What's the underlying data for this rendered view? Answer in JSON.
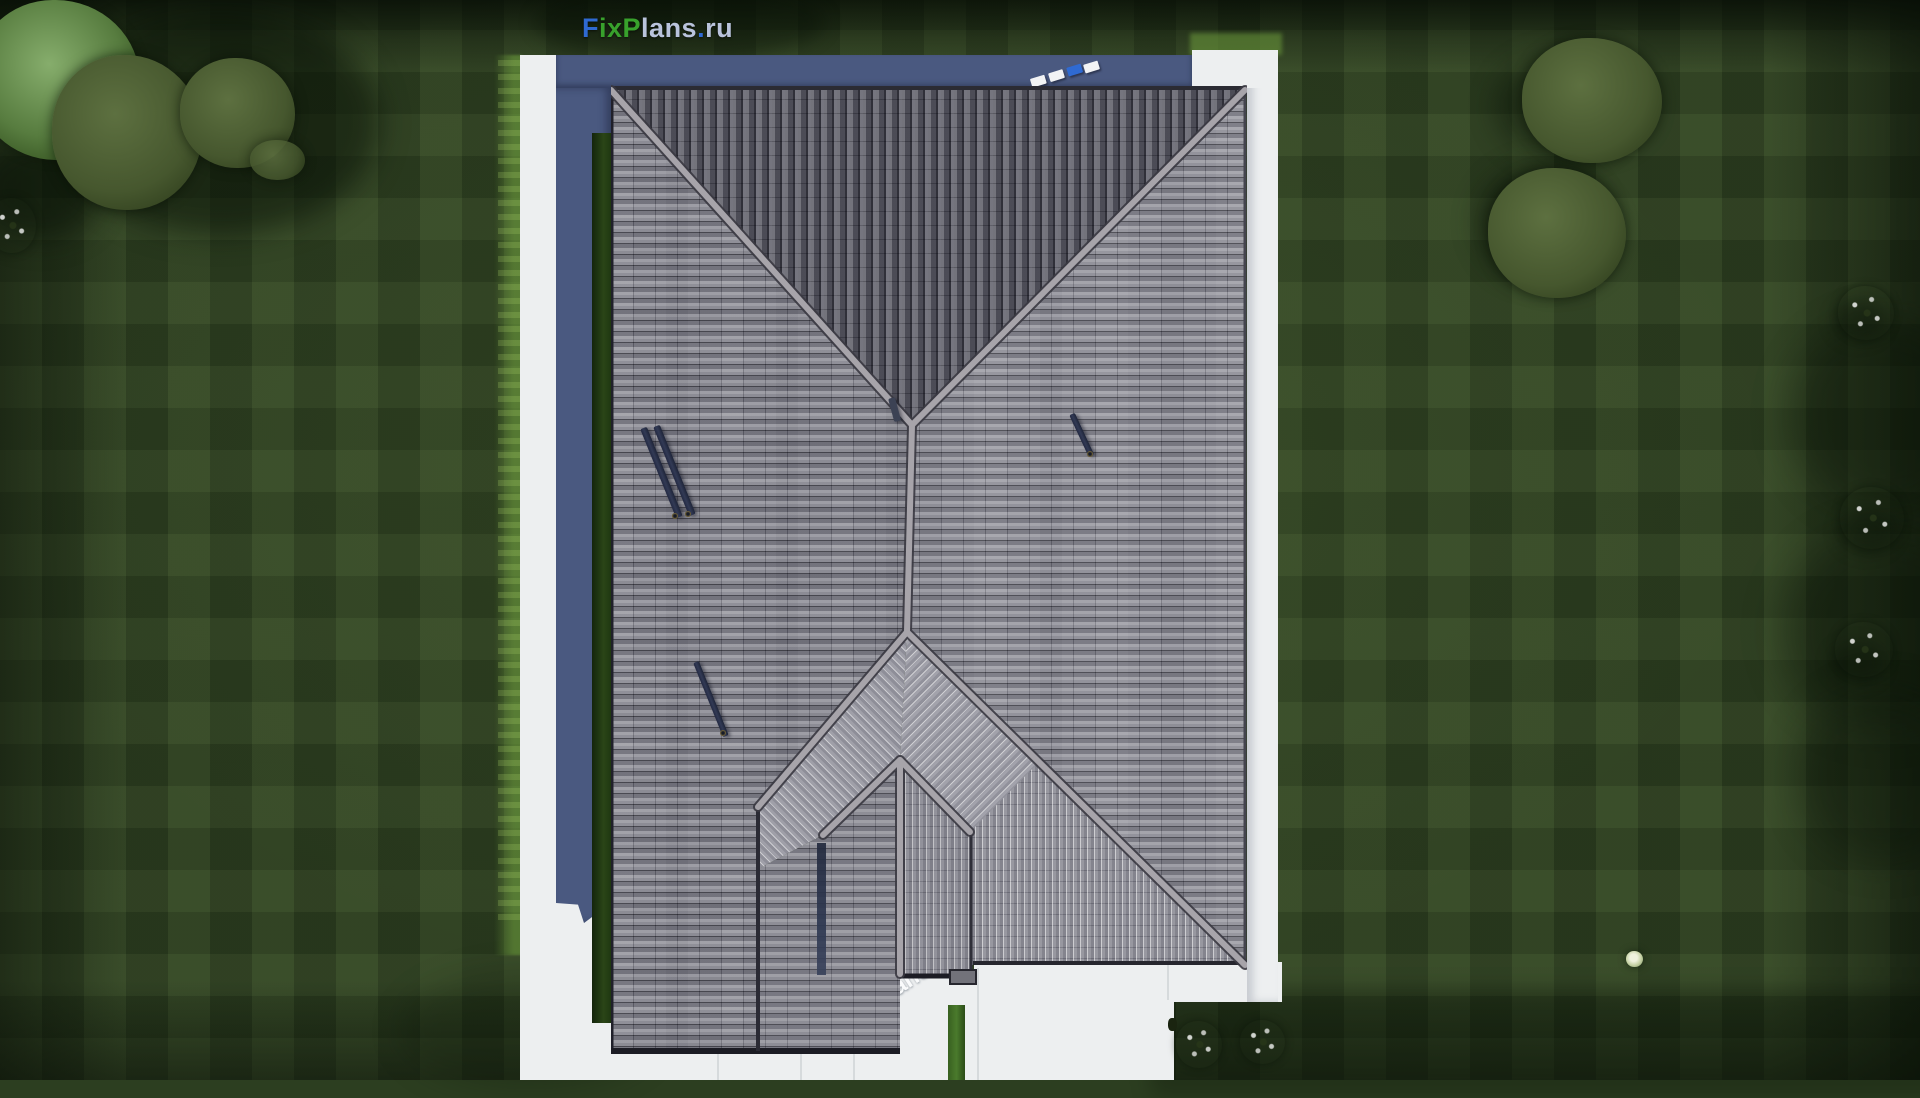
{
  "site_logo": {
    "text": "FixPlans.ru",
    "seg_f": "F",
    "seg_ix": "ix",
    "seg_p": "P",
    "seg_lans": "lans",
    "seg_dot": ".",
    "seg_ru": "ru"
  },
  "watermark_bottom": {
    "seg_pre": "ans",
    "seg_dot": ".",
    "seg_post": "ru"
  },
  "palette": {
    "logo_blue": "#2f6ad2",
    "logo_green": "#38a12c",
    "logo_pale": "#b9c3dc",
    "grass_base": "#2c3e20",
    "paving_white": "#edeff0",
    "shadow_band_blue": "#4a5980",
    "hedge_green": "#2a4517",
    "roof_north": "#75757d",
    "roof_west": "#87878f",
    "roof_east": "#8e8e96",
    "roof_south": "#9a9aa2",
    "roof_porch": "#a2a2aa",
    "ridge_gray": "#a7a4aa",
    "eave_dark": "#1c1c24",
    "solar_bar_navy": "#2e3349"
  }
}
